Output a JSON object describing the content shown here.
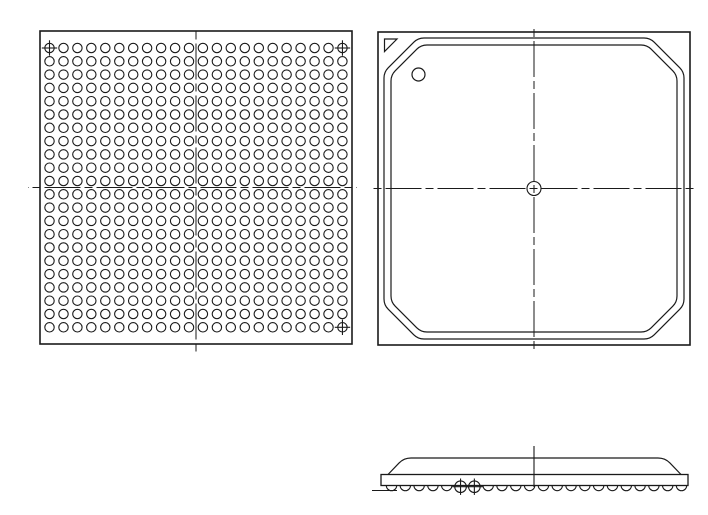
{
  "page": {
    "width": 708,
    "height": 515,
    "background": "#ffffff",
    "ink": "#1a1a1a"
  },
  "drawing": {
    "kind": "BGA package mechanical drawing (line art, no text labels)",
    "centerline_dash": [
      36,
      4,
      8,
      4
    ],
    "views": {
      "bottom": {
        "label": "bottom-view-ball-grid",
        "outline": {
          "x": 40,
          "y": 31,
          "w": 312,
          "h": 313,
          "stroke_width": 1.6
        },
        "grid": {
          "cols": 22,
          "rows": 22,
          "start_x": 49.5,
          "start_y": 48,
          "step_x": 13.95,
          "step_y": 13.3,
          "ball_radius": 4.7,
          "stroke_width": 1.1
        },
        "fiducial_cells": [
          [
            0,
            0
          ],
          [
            21,
            0
          ],
          [
            21,
            21
          ]
        ],
        "fiducial": {
          "radius": 4.7,
          "cross_overhang": 3
        },
        "centerlines": {
          "vertical": {
            "x": 196,
            "y1": 31,
            "y2": 352
          },
          "horizontal": {
            "y": 187.5,
            "x1": 28,
            "x2": 357
          }
        }
      },
      "top": {
        "label": "top-view-package-body",
        "outline": {
          "x": 378,
          "y": 32,
          "w": 312,
          "h": 313,
          "stroke_width": 1.6
        },
        "mold_outline_outer": {
          "inset": 6,
          "chamfer": 34,
          "corner_radius": 6,
          "stroke_width": 1.2
        },
        "mold_outline_inner": {
          "inset": 13,
          "chamfer": 30,
          "corner_radius": 6,
          "stroke_width": 1.2
        },
        "pin1_triangle": [
          [
            384.5,
            39
          ],
          [
            397,
            39
          ],
          [
            384.5,
            51.5
          ]
        ],
        "pin1_dimple": {
          "cx": 418.5,
          "cy": 74.5,
          "r": 6.5
        },
        "center_target": {
          "cx": 534,
          "cy": 188.5,
          "r": 7
        },
        "centerlines": {
          "vertical": {
            "x": 534,
            "y1": 27,
            "y2": 351
          },
          "horizontal": {
            "y": 188.5,
            "x1": 371,
            "x2": 696
          }
        }
      },
      "side": {
        "label": "side-view-profile",
        "substrate": {
          "x": 381,
          "y": 474.5,
          "w": 307,
          "h": 11,
          "stroke_width": 1.3
        },
        "mold_cap": {
          "x1": 388,
          "x2": 681,
          "y_top": 458,
          "y_base": 474.5,
          "shoulder": 16,
          "corner_radius": 7,
          "stroke_width": 1.2
        },
        "balls": {
          "count": 22,
          "start_x": 391.5,
          "step_x": 13.81,
          "center_y": 485.5,
          "radius": 5.2,
          "stroke_width": 1.1,
          "fiducial_indices": [
            5,
            6
          ]
        },
        "datum_line": {
          "x1": 372,
          "x2": 397,
          "y": 490.5
        },
        "centerline": {
          "x": 534,
          "y1": 446,
          "y2": 487
        }
      }
    }
  }
}
